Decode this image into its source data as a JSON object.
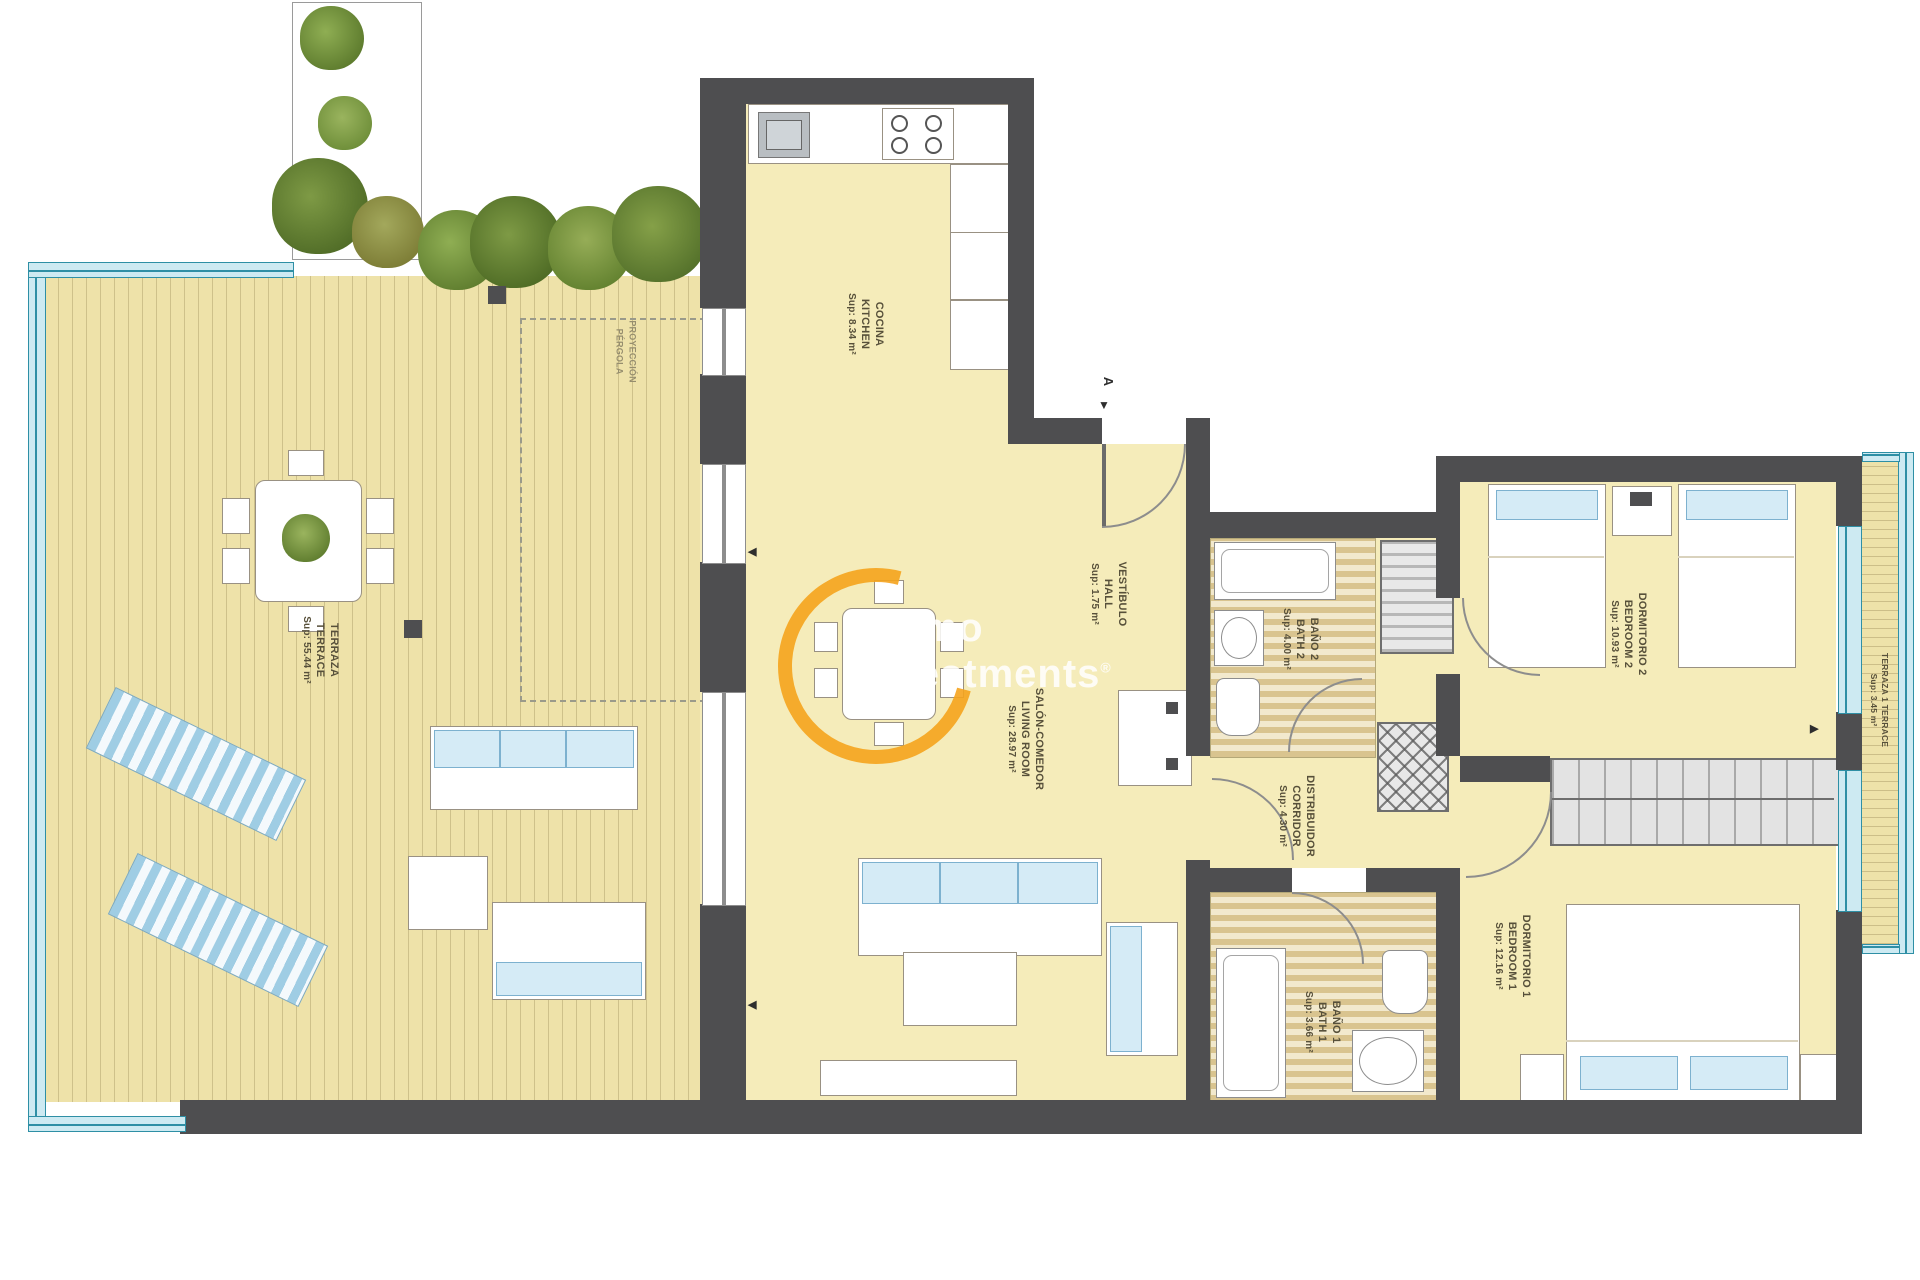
{
  "rooms": {
    "kitchen": {
      "name_es": "COCINA",
      "name_en": "KITCHEN",
      "area": "Sup: 8.34 m²"
    },
    "hall": {
      "name_es": "VESTÍBULO",
      "name_en": "HALL",
      "area": "Sup: 1.75 m²"
    },
    "living": {
      "name_es": "SALÓN-COMEDOR",
      "name_en": "LIVING ROOM",
      "area": "Sup: 28.97 m²"
    },
    "terrace": {
      "name_es": "TERRAZA",
      "name_en": "TERRACE",
      "area": "Sup: 55.44 m²"
    },
    "bath2": {
      "name_es": "BAÑO 2",
      "name_en": "BATH 2",
      "area": "Sup: 4.00 m²"
    },
    "corridor": {
      "name_es": "DISTRIBUIDOR",
      "name_en": "CORRIDOR",
      "area": "Sup: 4.30 m²"
    },
    "bedroom2": {
      "name_es": "DORMITORIO 2",
      "name_en": "BEDROOM 2",
      "area": "Sup: 10.93 m²"
    },
    "bedroom1": {
      "name_es": "DORMITORIO 1",
      "name_en": "BEDROOM 1",
      "area": "Sup: 12.16 m²"
    },
    "bath1": {
      "name_es": "BAÑO 1",
      "name_en": "BATH 1",
      "area": "Sup: 3.66 m²"
    },
    "terrace1": {
      "name_es": "TERRAZA 1 TERRACE",
      "area": "Sup: 3.45 m²"
    }
  },
  "pergola_note": {
    "line1": "PROYECCIÓN",
    "line2": "PÉRGOLA"
  },
  "section_marker": {
    "label": "A",
    "arrow": "▼"
  },
  "arrows": {
    "left_upper": "◀",
    "left_lower": "◀",
    "right": "▶"
  },
  "watermark": {
    "line1": "inmo",
    "line2": "investments",
    "reg": "®"
  },
  "colors": {
    "wall": "#4e4e50",
    "floor": "#f5ecba",
    "deck": "#eee2a9",
    "glass": "#2e8fa5",
    "cushion_blue": "#d5ebf6",
    "watermark_orange": "#f6a41d",
    "label_text": "#57503a"
  }
}
